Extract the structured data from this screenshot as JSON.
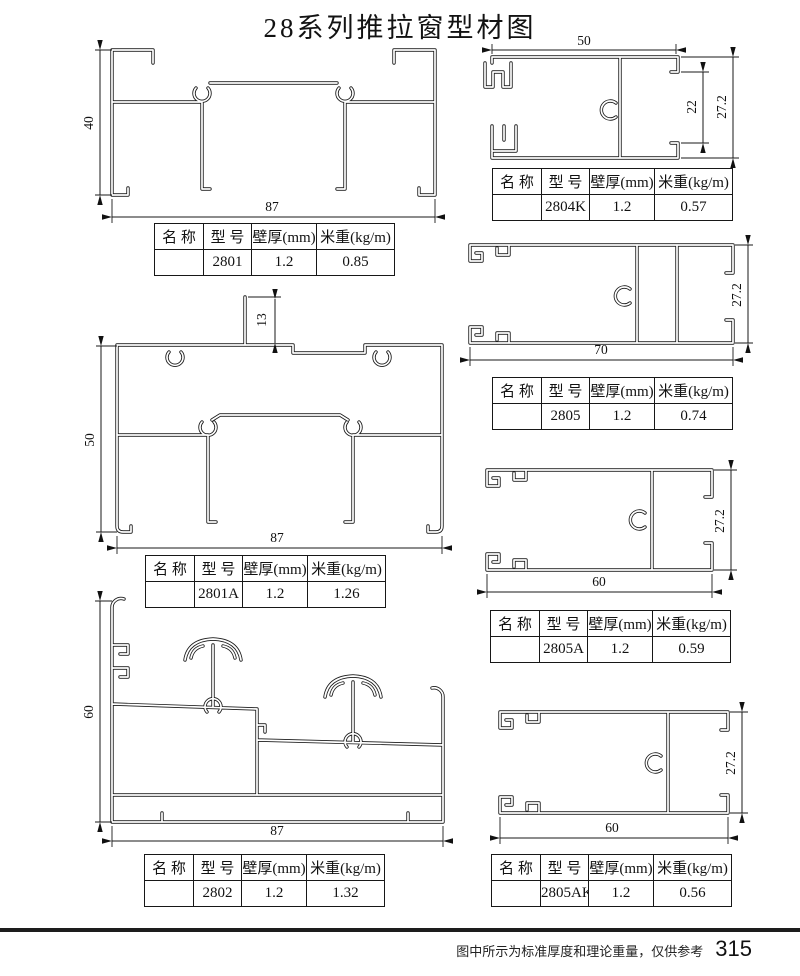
{
  "page": {
    "title": "28系列推拉窗型材图"
  },
  "footer": {
    "note": "图中所示为标准厚度和理论重量，仅供参考",
    "page_number": "315"
  },
  "table_headers": {
    "name": "名 称",
    "model": "型 号",
    "thickness": "壁厚(mm)",
    "weight": "米重(kg/m)"
  },
  "profiles": [
    {
      "model": "2801",
      "name": "",
      "thickness": "1.2",
      "weight": "0.85",
      "dims": {
        "height": "40",
        "width": "87"
      }
    },
    {
      "model": "2801A",
      "name": "",
      "thickness": "1.2",
      "weight": "1.26",
      "dims": {
        "height": "50",
        "width": "87",
        "fin": "13"
      }
    },
    {
      "model": "2802",
      "name": "",
      "thickness": "1.2",
      "weight": "1.32",
      "dims": {
        "height": "60",
        "width": "87"
      }
    },
    {
      "model": "2804K",
      "name": "",
      "thickness": "1.2",
      "weight": "0.57",
      "dims": {
        "width": "50",
        "inner_height": "22",
        "height": "27.2"
      }
    },
    {
      "model": "2805",
      "name": "",
      "thickness": "1.2",
      "weight": "0.74",
      "dims": {
        "width": "70",
        "height": "27.2"
      }
    },
    {
      "model": "2805A",
      "name": "",
      "thickness": "1.2",
      "weight": "0.59",
      "dims": {
        "width": "60",
        "height": "27.2"
      }
    },
    {
      "model": "2805AK",
      "name": "",
      "thickness": "1.2",
      "weight": "0.56",
      "dims": {
        "width": "60",
        "height": "27.2"
      }
    }
  ]
}
